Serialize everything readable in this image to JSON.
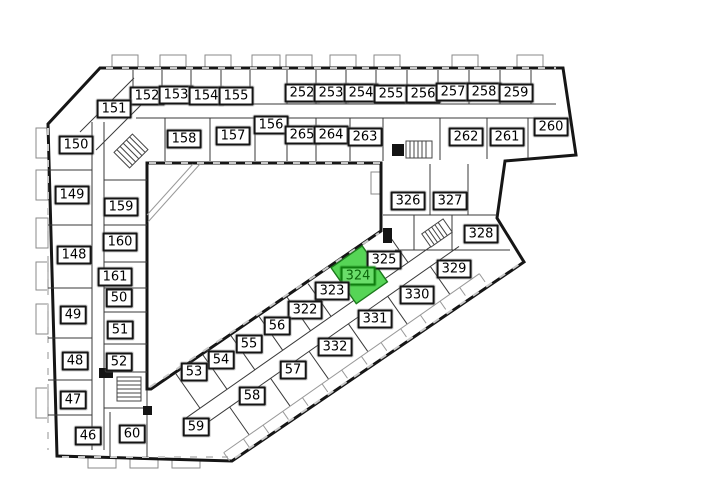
{
  "page": {
    "background_color": "#ffffff"
  },
  "plan": {
    "selected_unit": {
      "id": "324",
      "fill": "#56d556",
      "outline": "#1c7a1c",
      "label_bg": "#6ade6a",
      "label_border": "#0f7f0f",
      "label_text": "#0b660b"
    },
    "unit_label_style": {
      "bg": "#ffffff",
      "border": "#141414",
      "text": "#000000"
    },
    "units": [
      {
        "id": "152",
        "x": 147,
        "y": 96
      },
      {
        "id": "153",
        "x": 176,
        "y": 95
      },
      {
        "id": "154",
        "x": 206,
        "y": 96
      },
      {
        "id": "155",
        "x": 236,
        "y": 96
      },
      {
        "id": "252",
        "x": 302,
        "y": 93
      },
      {
        "id": "253",
        "x": 331,
        "y": 93
      },
      {
        "id": "254",
        "x": 361,
        "y": 93
      },
      {
        "id": "255",
        "x": 391,
        "y": 94
      },
      {
        "id": "256",
        "x": 423,
        "y": 94
      },
      {
        "id": "257",
        "x": 453,
        "y": 92
      },
      {
        "id": "258",
        "x": 484,
        "y": 92
      },
      {
        "id": "259",
        "x": 516,
        "y": 93
      },
      {
        "id": "151",
        "x": 114,
        "y": 109
      },
      {
        "id": "156",
        "x": 271,
        "y": 125
      },
      {
        "id": "158",
        "x": 184,
        "y": 139
      },
      {
        "id": "157",
        "x": 233,
        "y": 136
      },
      {
        "id": "265",
        "x": 302,
        "y": 135
      },
      {
        "id": "264",
        "x": 331,
        "y": 135
      },
      {
        "id": "263",
        "x": 365,
        "y": 137
      },
      {
        "id": "262",
        "x": 466,
        "y": 137
      },
      {
        "id": "261",
        "x": 507,
        "y": 137
      },
      {
        "id": "260",
        "x": 551,
        "y": 127
      },
      {
        "id": "150",
        "x": 76,
        "y": 145
      },
      {
        "id": "149",
        "x": 72,
        "y": 195
      },
      {
        "id": "159",
        "x": 121,
        "y": 207
      },
      {
        "id": "160",
        "x": 120,
        "y": 242
      },
      {
        "id": "148",
        "x": 74,
        "y": 255
      },
      {
        "id": "161",
        "x": 115,
        "y": 277
      },
      {
        "id": "50",
        "x": 119,
        "y": 298
      },
      {
        "id": "49",
        "x": 73,
        "y": 315
      },
      {
        "id": "51",
        "x": 120,
        "y": 330
      },
      {
        "id": "48",
        "x": 75,
        "y": 361
      },
      {
        "id": "52",
        "x": 119,
        "y": 362
      },
      {
        "id": "47",
        "x": 73,
        "y": 400
      },
      {
        "id": "46",
        "x": 88,
        "y": 436
      },
      {
        "id": "60",
        "x": 132,
        "y": 434
      },
      {
        "id": "326",
        "x": 408,
        "y": 201
      },
      {
        "id": "327",
        "x": 450,
        "y": 201
      },
      {
        "id": "328",
        "x": 481,
        "y": 234
      },
      {
        "id": "329",
        "x": 454,
        "y": 269
      },
      {
        "id": "325",
        "x": 384,
        "y": 260
      },
      {
        "id": "324",
        "x": 358,
        "y": 276
      },
      {
        "id": "323",
        "x": 332,
        "y": 291
      },
      {
        "id": "330",
        "x": 417,
        "y": 295
      },
      {
        "id": "322",
        "x": 305,
        "y": 310
      },
      {
        "id": "331",
        "x": 375,
        "y": 319
      },
      {
        "id": "332",
        "x": 335,
        "y": 347
      },
      {
        "id": "56",
        "x": 277,
        "y": 326
      },
      {
        "id": "55",
        "x": 249,
        "y": 344
      },
      {
        "id": "54",
        "x": 221,
        "y": 360
      },
      {
        "id": "53",
        "x": 194,
        "y": 372
      },
      {
        "id": "57",
        "x": 293,
        "y": 370
      },
      {
        "id": "58",
        "x": 252,
        "y": 396
      },
      {
        "id": "59",
        "x": 196,
        "y": 427
      }
    ]
  }
}
